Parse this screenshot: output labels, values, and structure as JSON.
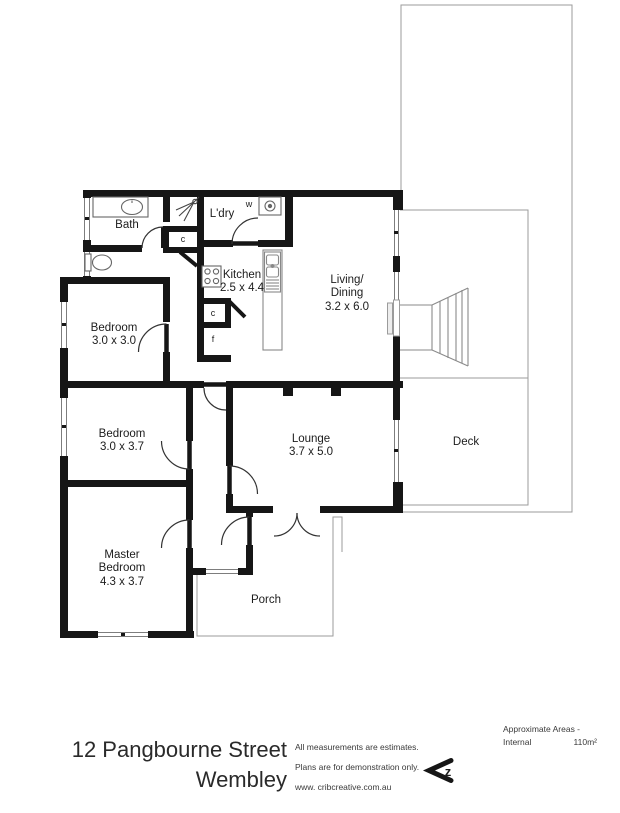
{
  "plan": {
    "rooms": {
      "bath": {
        "label": "Bath"
      },
      "laundry": {
        "label": "L'dry"
      },
      "kitchen": {
        "label": "Kitchen",
        "dims": "2.5 x 4.4"
      },
      "living_dining": {
        "label_line1": "Living/",
        "label_line2": "Dining",
        "dims": "3.2 x 6.0"
      },
      "bedroom1": {
        "label": "Bedroom",
        "dims": "3.0 x 3.0"
      },
      "bedroom2": {
        "label": "Bedroom",
        "dims": "3.0 x 3.7"
      },
      "lounge": {
        "label": "Lounge",
        "dims": "3.7 x 5.0"
      },
      "master_bedroom": {
        "label_line1": "Master",
        "label_line2": "Bedroom",
        "dims": "4.3 x 3.7"
      },
      "porch": {
        "label": "Porch"
      },
      "deck": {
        "label": "Deck"
      }
    },
    "markers": {
      "washer": "w",
      "hall_closet": "c",
      "kitchen_closet": "c",
      "fridge": "f"
    },
    "colors": {
      "wall": "#161616",
      "thin_line": "#9b9b9b",
      "text": "#1c1c1c"
    }
  },
  "footer": {
    "title_line1": "12 Pangbourne Street",
    "title_line2": "Wembley",
    "notes": [
      "All measurements are estimates.",
      "Plans are for demonstration only.",
      "www. cribcreative.com.au"
    ],
    "areas": {
      "heading": "Approximate Areas -",
      "name": "Internal",
      "value": "110m²"
    },
    "logo_letter": "z"
  }
}
